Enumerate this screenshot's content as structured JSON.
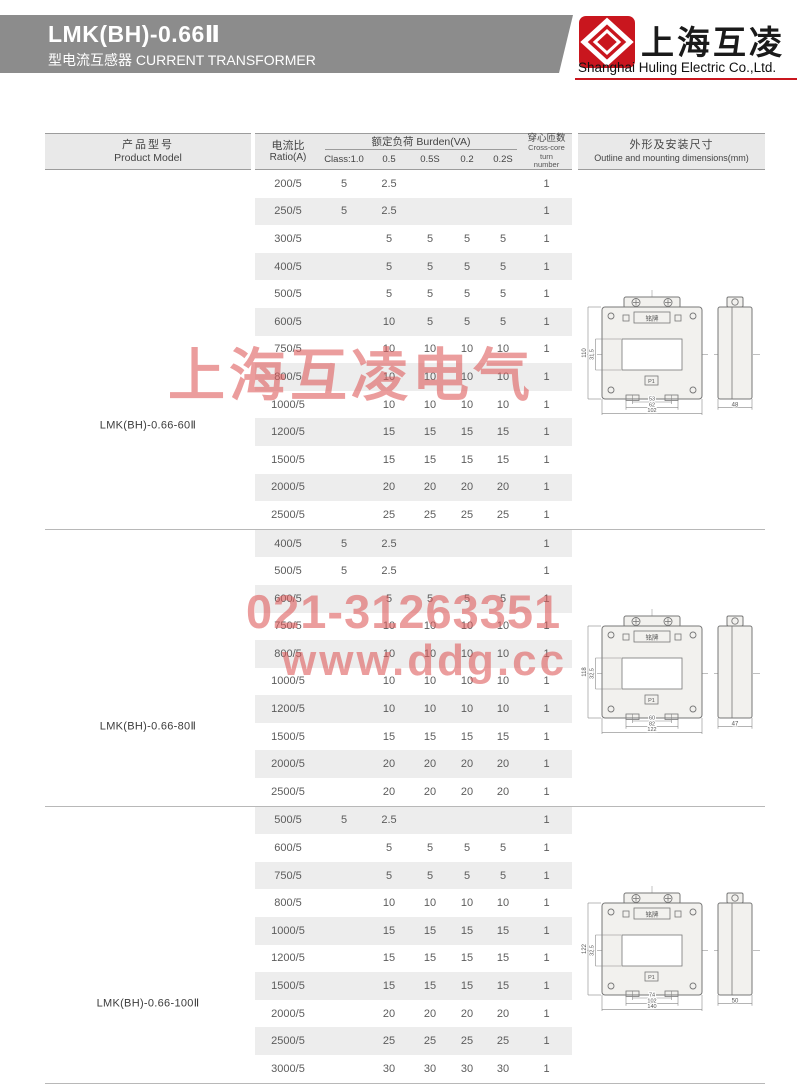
{
  "header": {
    "title": "LMK(BH)-0.66Ⅱ",
    "subtitle": "型电流互感器 CURRENT TRANSFORMER",
    "brand_cn": "上海互凌",
    "brand_en": "Shanghai Huling Electric Co.,Ltd.",
    "colors": {
      "band_gray": "#8c8c8c",
      "brand_red": "#c9161e"
    }
  },
  "watermarks": {
    "brand": "上海互凌电气",
    "phone": "021-31263351",
    "url": "www.ddg.cc",
    "color": "#de5c5c"
  },
  "table": {
    "header": {
      "product_cn": "产品型号",
      "product_en": "Product Model",
      "ratio_cn": "电流比",
      "ratio_en": "Ratio(A)",
      "burden": "额定负荷 Burden(VA)",
      "classes": [
        "Class:1.0",
        "0.5",
        "0.5S",
        "0.2",
        "0.2S"
      ],
      "turns_cn": "穿心匝数",
      "turns_en": [
        "Cross-core",
        "turn",
        "number"
      ],
      "outline_cn": "外形及安装尺寸",
      "outline_en": "Outline and mounting dimensions(mm)"
    },
    "groups": [
      {
        "model": "LMK(BH)-0.66-60Ⅱ",
        "rows": [
          {
            "cells": [
              "200/5",
              "5",
              "2.5",
              "",
              "",
              "",
              "1"
            ]
          },
          {
            "cells": [
              "250/5",
              "5",
              "2.5",
              "",
              "",
              "",
              "1"
            ]
          },
          {
            "cells": [
              "300/5",
              "",
              "5",
              "5",
              "5",
              "5",
              "1"
            ]
          },
          {
            "cells": [
              "400/5",
              "",
              "5",
              "5",
              "5",
              "5",
              "1"
            ]
          },
          {
            "cells": [
              "500/5",
              "",
              "5",
              "5",
              "5",
              "5",
              "1"
            ]
          },
          {
            "cells": [
              "600/5",
              "",
              "10",
              "5",
              "5",
              "5",
              "1"
            ]
          },
          {
            "cells": [
              "750/5",
              "",
              "10",
              "10",
              "10",
              "10",
              "1"
            ]
          },
          {
            "cells": [
              "800/5",
              "",
              "10",
              "10",
              "10",
              "10",
              "1"
            ]
          },
          {
            "cells": [
              "1000/5",
              "",
              "10",
              "10",
              "10",
              "10",
              "1"
            ]
          },
          {
            "cells": [
              "1200/5",
              "",
              "15",
              "15",
              "15",
              "15",
              "1"
            ]
          },
          {
            "cells": [
              "1500/5",
              "",
              "15",
              "15",
              "15",
              "15",
              "1"
            ]
          },
          {
            "cells": [
              "2000/5",
              "",
              "20",
              "20",
              "20",
              "20",
              "1"
            ]
          },
          {
            "cells": [
              "2500/5",
              "",
              "25",
              "25",
              "25",
              "25",
              "1"
            ]
          }
        ],
        "drawing": {
          "height": "110",
          "window": "31.5",
          "holes": "53",
          "mid": "62",
          "width": "102",
          "depth": "48"
        }
      },
      {
        "model": "LMK(BH)-0.66-80Ⅱ",
        "rows": [
          {
            "cells": [
              "400/5",
              "5",
              "2.5",
              "",
              "",
              "",
              "1"
            ]
          },
          {
            "cells": [
              "500/5",
              "5",
              "2.5",
              "",
              "",
              "",
              "1"
            ]
          },
          {
            "cells": [
              "600/5",
              "",
              "5",
              "5",
              "5",
              "5",
              "1"
            ]
          },
          {
            "cells": [
              "750/5",
              "",
              "10",
              "10",
              "10",
              "10",
              "1"
            ]
          },
          {
            "cells": [
              "800/5",
              "",
              "10",
              "10",
              "10",
              "10",
              "1"
            ]
          },
          {
            "cells": [
              "1000/5",
              "",
              "10",
              "10",
              "10",
              "10",
              "1"
            ]
          },
          {
            "cells": [
              "1200/5",
              "",
              "10",
              "10",
              "10",
              "10",
              "1"
            ]
          },
          {
            "cells": [
              "1500/5",
              "",
              "15",
              "15",
              "15",
              "15",
              "1"
            ]
          },
          {
            "cells": [
              "2000/5",
              "",
              "20",
              "20",
              "20",
              "20",
              "1"
            ]
          },
          {
            "cells": [
              "2500/5",
              "",
              "20",
              "20",
              "20",
              "20",
              "1"
            ]
          }
        ],
        "drawing": {
          "height": "118",
          "window": "32.5",
          "holes": "60",
          "mid": "82",
          "width": "122",
          "depth": "47"
        }
      },
      {
        "model": "LMK(BH)-0.66-100Ⅱ",
        "rows": [
          {
            "cells": [
              "500/5",
              "5",
              "2.5",
              "",
              "",
              "",
              "1"
            ]
          },
          {
            "cells": [
              "600/5",
              "",
              "5",
              "5",
              "5",
              "5",
              "1"
            ]
          },
          {
            "cells": [
              "750/5",
              "",
              "5",
              "5",
              "5",
              "5",
              "1"
            ]
          },
          {
            "cells": [
              "800/5",
              "",
              "10",
              "10",
              "10",
              "10",
              "1"
            ]
          },
          {
            "cells": [
              "1000/5",
              "",
              "15",
              "15",
              "15",
              "15",
              "1"
            ]
          },
          {
            "cells": [
              "1200/5",
              "",
              "15",
              "15",
              "15",
              "15",
              "1"
            ]
          },
          {
            "cells": [
              "1500/5",
              "",
              "15",
              "15",
              "15",
              "15",
              "1"
            ]
          },
          {
            "cells": [
              "2000/5",
              "",
              "20",
              "20",
              "20",
              "20",
              "1"
            ]
          },
          {
            "cells": [
              "2500/5",
              "",
              "25",
              "25",
              "25",
              "25",
              "1"
            ]
          },
          {
            "cells": [
              "3000/5",
              "",
              "30",
              "30",
              "30",
              "30",
              "1"
            ]
          }
        ],
        "drawing": {
          "height": "122",
          "window": "32.5",
          "holes": "74",
          "mid": "102",
          "width": "140",
          "depth": "50"
        }
      }
    ]
  },
  "drawing_labels": {
    "nameplate": "铭牌",
    "p1": "P1"
  }
}
